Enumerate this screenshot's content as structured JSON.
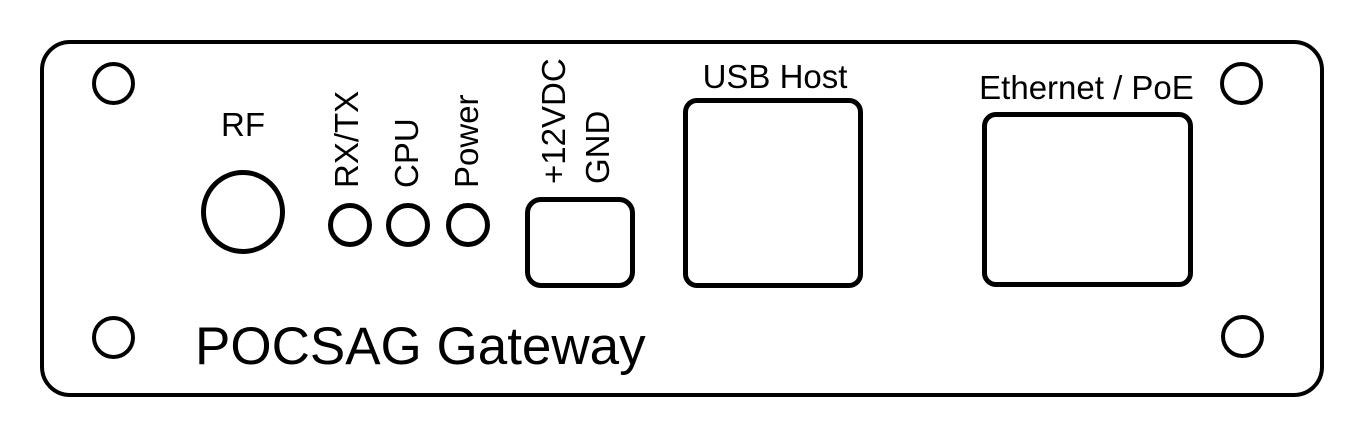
{
  "diagram": {
    "title": "POCSAG Gateway",
    "colors": {
      "line": "#000000",
      "background": "#ffffff"
    },
    "rf": {
      "label": "RF"
    },
    "leds": {
      "rxtx": "RX/TX",
      "cpu": "CPU",
      "power": "Power"
    },
    "power_input": {
      "positive": "+12VDC",
      "ground": "GND"
    },
    "usb": {
      "label": "USB Host"
    },
    "ethernet": {
      "label": "Ethernet / PoE"
    }
  }
}
